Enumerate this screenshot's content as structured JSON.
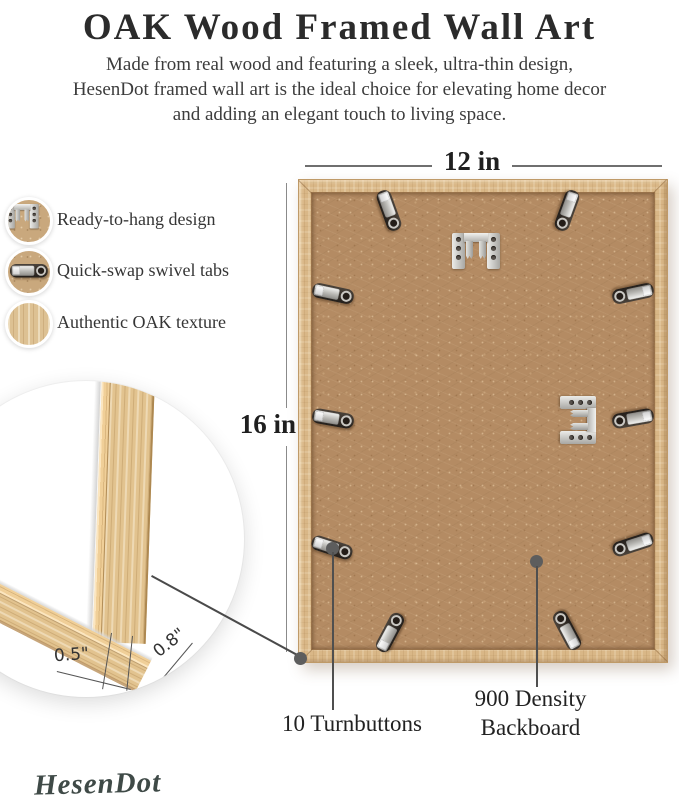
{
  "header": {
    "title": "OAK Wood Framed Wall Art",
    "subtitle_lines": [
      "Made from real wood and featuring a sleek, ultra-thin design,",
      "HesenDot framed wall art is the ideal choice for elevating home decor",
      "and adding an elegant touch to living space."
    ]
  },
  "features": {
    "items": [
      {
        "icon": "sawtooth-hanger-icon",
        "label": "Ready-to-hang design"
      },
      {
        "icon": "swivel-tab-icon",
        "label": "Quick-swap swivel tabs"
      },
      {
        "icon": "oak-texture-icon",
        "label": "Authentic OAK texture"
      }
    ]
  },
  "dimensions": {
    "width_label": "12 in",
    "height_label": "16 in"
  },
  "callouts": {
    "turnbuttons": "10 Turnbuttons",
    "backboard_line1": "900 Density",
    "backboard_line2": "Backboard"
  },
  "detail": {
    "face_width": "0.5\"",
    "frame_depth": "0.8\""
  },
  "brand": {
    "logo_text": "HesenDot"
  },
  "colors": {
    "backboard": "#b48b63",
    "oak_wood": "#d9b787",
    "metal": "#c9c8c4",
    "annotation_line": "#4f4f4f",
    "text": "#2b2b2b",
    "logo": "#3f4a47"
  }
}
